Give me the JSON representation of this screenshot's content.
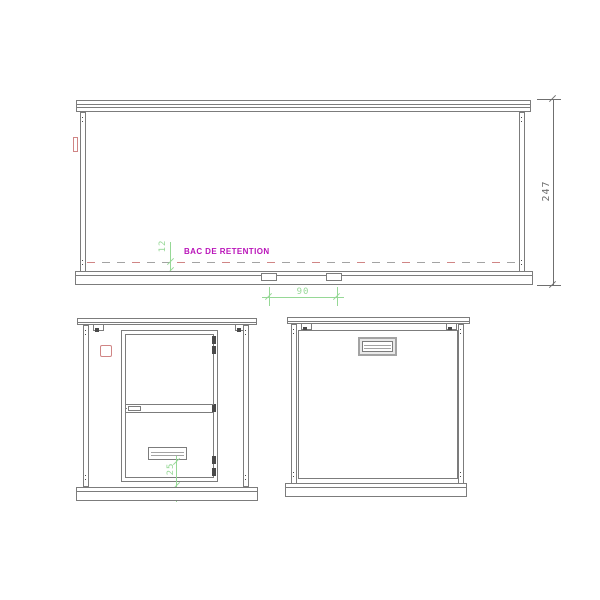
{
  "colors": {
    "background": "#ffffff",
    "line": "#7c7c7c",
    "line_light": "#a3a3a3",
    "line_dark": "#4a4a4a",
    "dimension": "#6f6f6f",
    "green": "#96d896",
    "magenta": "#b913b9",
    "red_accent": "#d08585"
  },
  "front": {
    "retention_label": "BAC DE RETENTION",
    "dims": {
      "retention_offset": "12",
      "slot_spacing": "90",
      "overall_height": "247"
    }
  },
  "side_door": {
    "dims": {
      "vent_offset": "25"
    }
  },
  "side_rear": {}
}
